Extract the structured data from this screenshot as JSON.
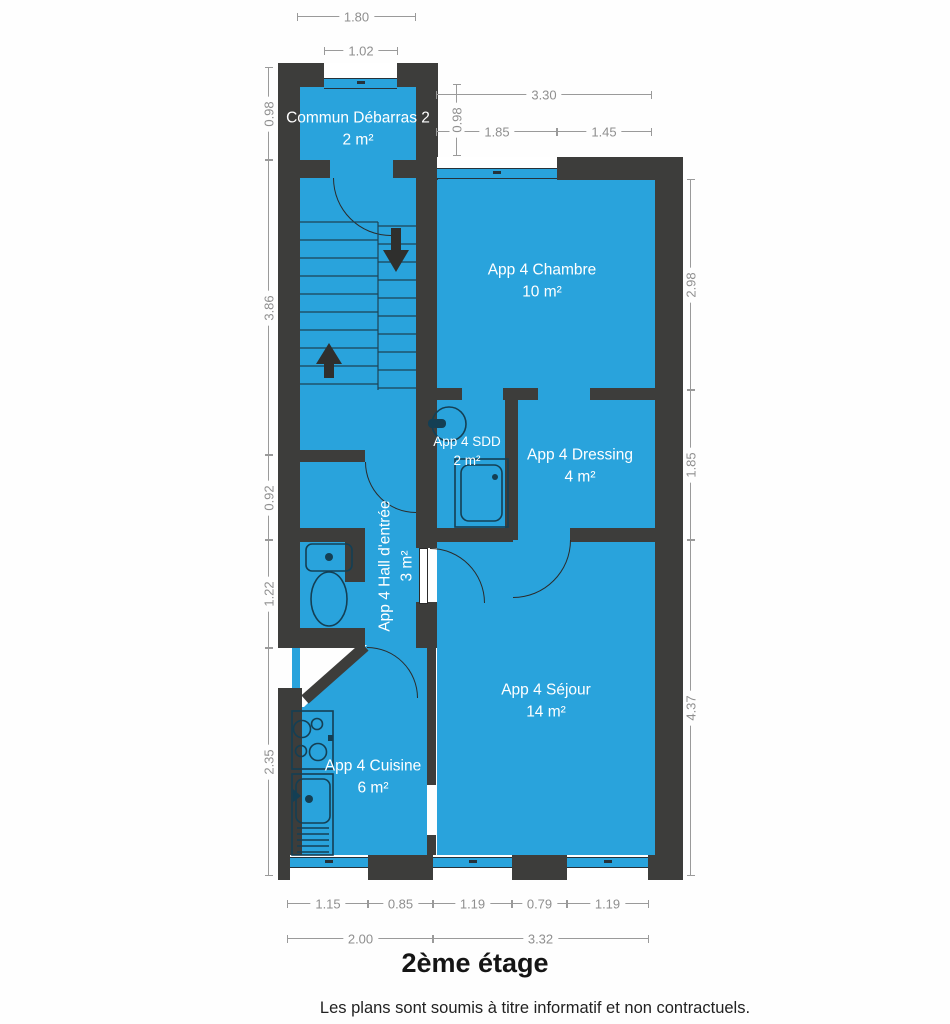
{
  "title": "2ème étage",
  "disclaimer": "Les plans sont soumis à titre informatif et non contractuels.",
  "colors": {
    "floor": "#29a3dc",
    "wall": "#3d3d3b",
    "dimension_line": "#9a9a9a",
    "dimension_text": "#8f8f8f",
    "fixture_line": "#143f54"
  },
  "rooms": {
    "debarras": {
      "name": "Commun Débarras 2",
      "area": "2 m²"
    },
    "chambre": {
      "name": "App 4 Chambre",
      "area": "10 m²"
    },
    "sdd": {
      "name": "App 4 SDD",
      "area": "2 m²"
    },
    "dressing": {
      "name": "App 4 Dressing",
      "area": "4 m²"
    },
    "hall": {
      "name": "App 4 Hall d'entrée",
      "area": "3 m²"
    },
    "sejour": {
      "name": "App 4 Séjour",
      "area": "14 m²"
    },
    "cuisine": {
      "name": "App 4 Cuisine",
      "area": "6 m²"
    }
  },
  "dims": {
    "top_outer": "1.80",
    "top_window": "1.02",
    "chambre_total": "3.30",
    "chambre_window": "1.85",
    "chambre_wall": "1.45",
    "debarras_left": "0.98",
    "debarras_right": "0.98",
    "stairs_left": "3.86",
    "wc_upper_left": "0.92",
    "wc_left": "1.22",
    "cuisine_left": "2.35",
    "chambre_right": "2.98",
    "dressing_right": "1.85",
    "sejour_right": "4.37",
    "bottom_win1": "1.15",
    "bottom_wall1": "0.85",
    "bottom_win2": "1.19",
    "bottom_wall2": "0.79",
    "bottom_win3": "1.19",
    "bottom_total_left": "2.00",
    "bottom_total_right": "3.32"
  }
}
